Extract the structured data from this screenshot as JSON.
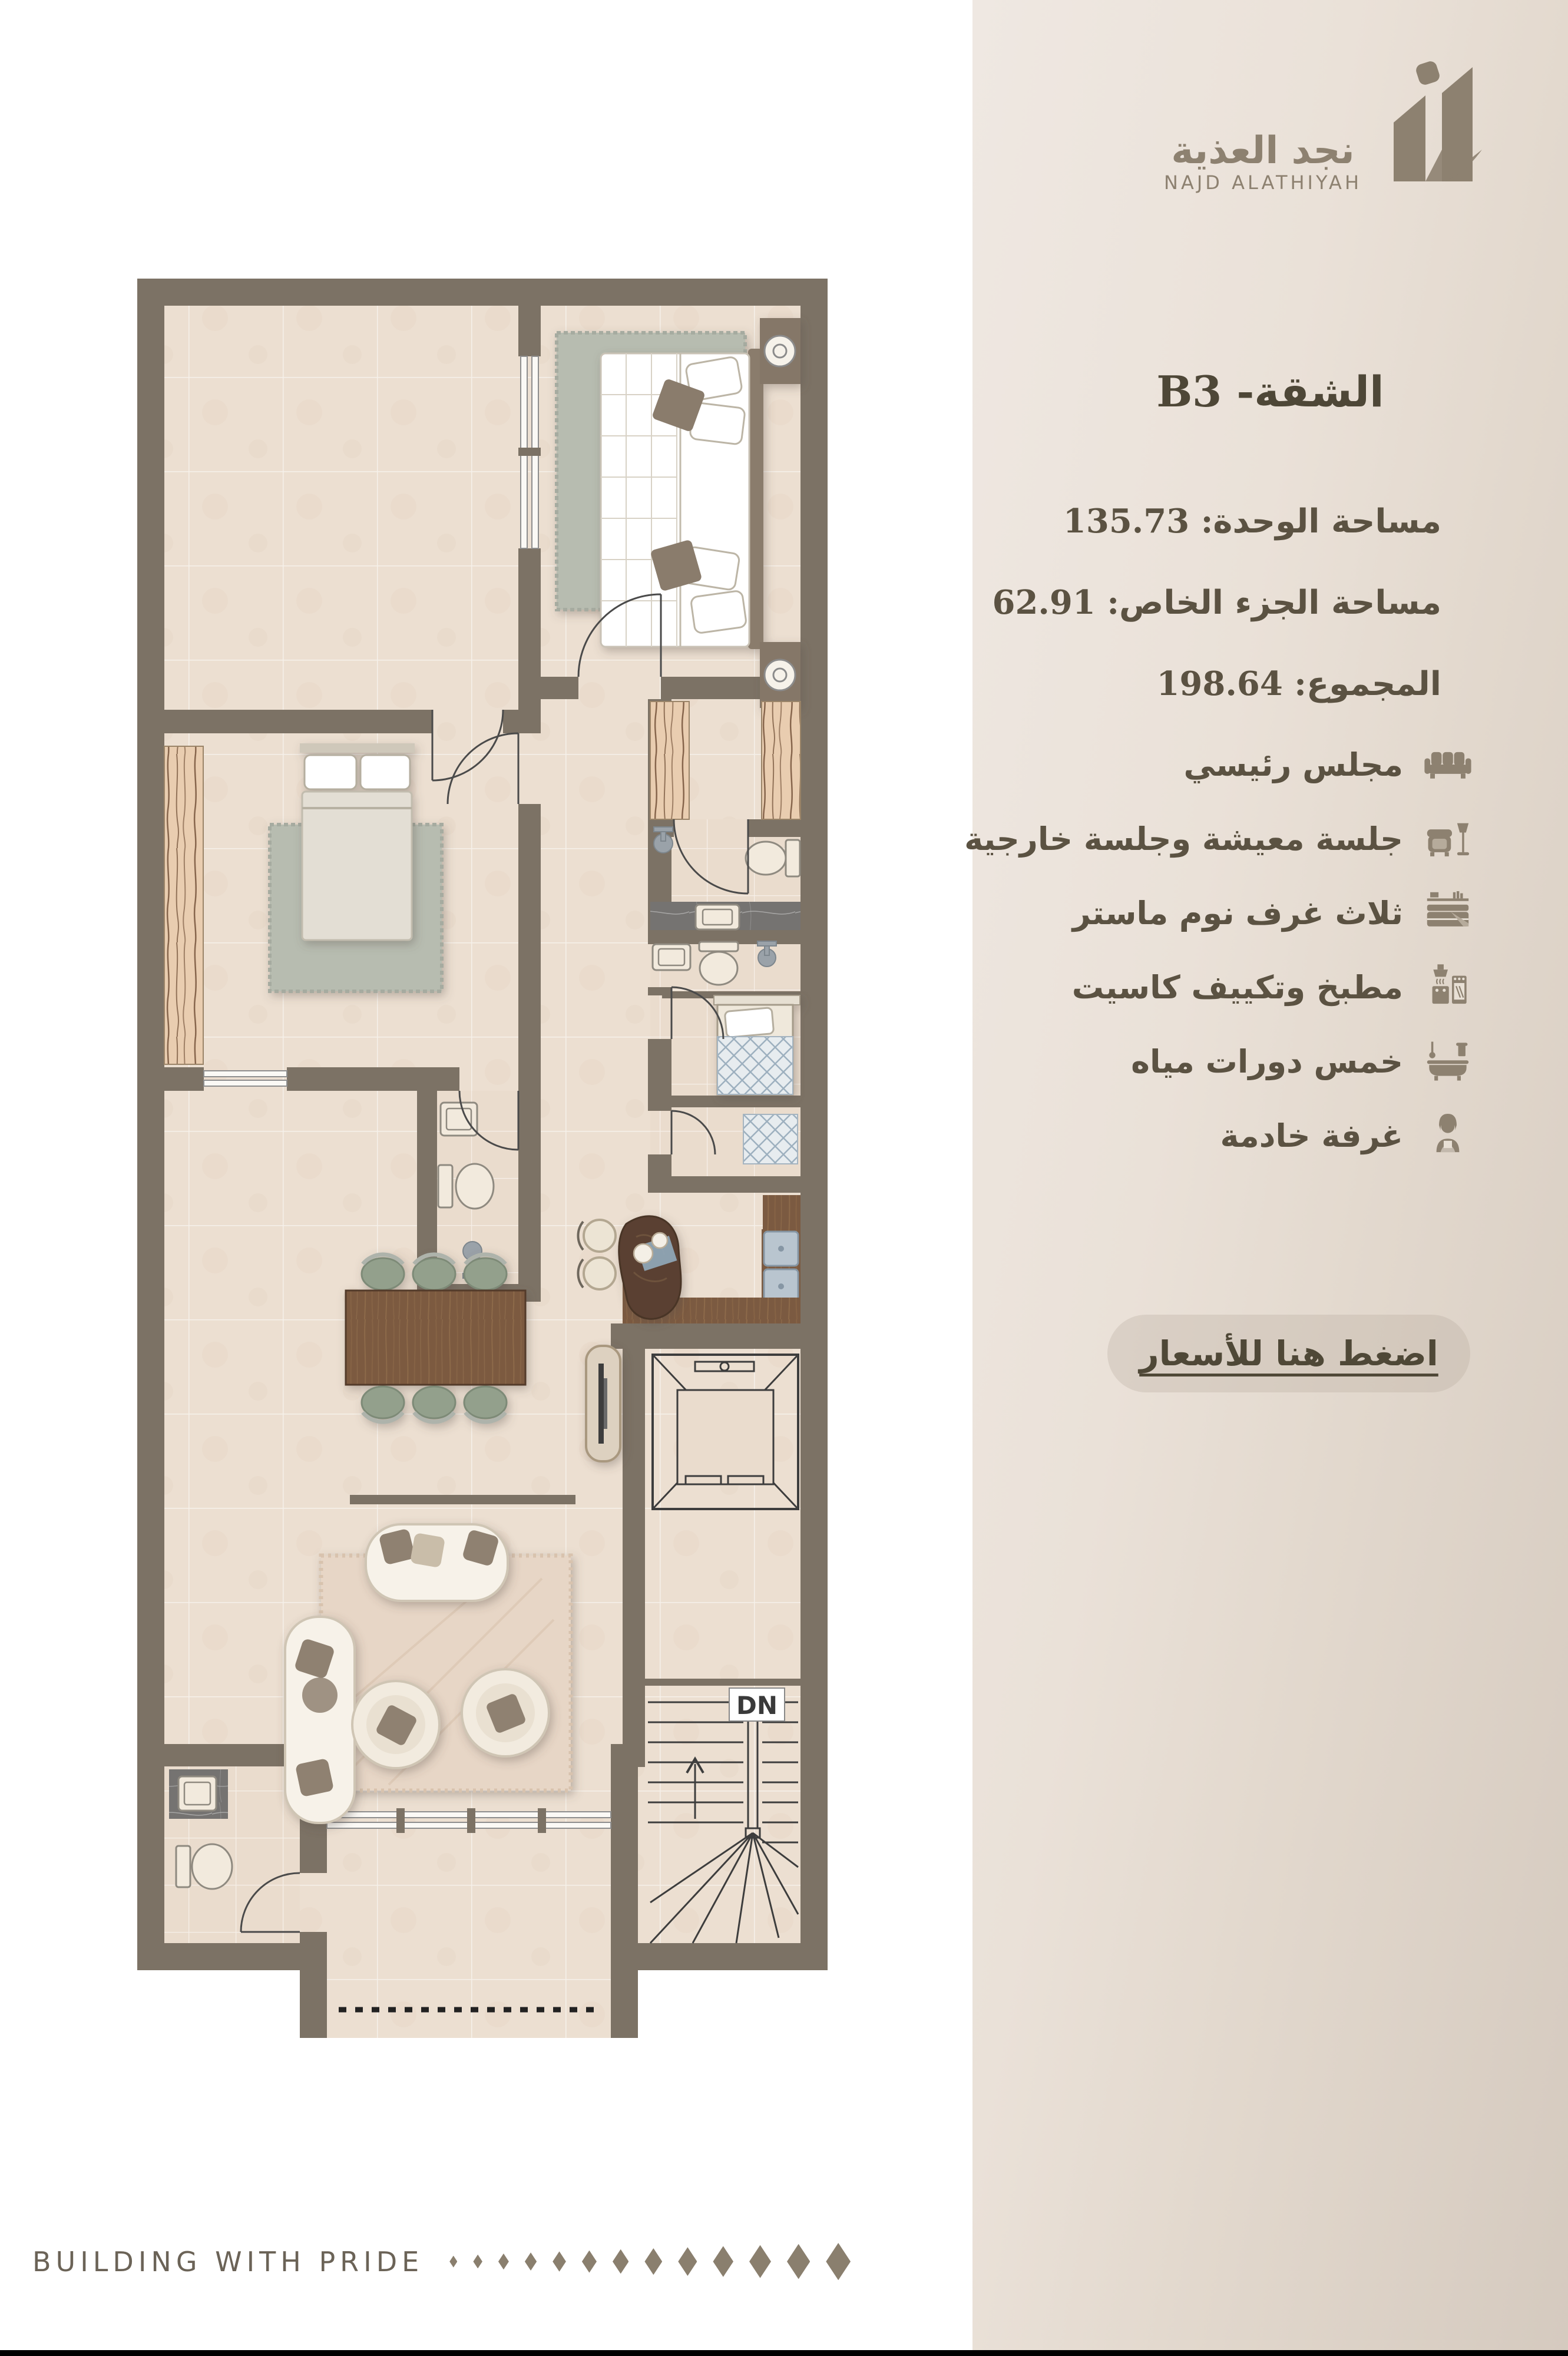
{
  "brand": {
    "logo_ar": "نجد العذية",
    "logo_en": "NAJD ALATHIYAH"
  },
  "unit": {
    "title": "الشقة- B3"
  },
  "specs": [
    {
      "text": "مساحة الوحدة: 135.73"
    },
    {
      "text": "مساحة الجزء الخاص: 62.91"
    },
    {
      "text": "المجموع: 198.64"
    }
  ],
  "features": [
    {
      "icon": "sofa-icon",
      "label": "مجلس رئيسي"
    },
    {
      "icon": "armchair-lamp-icon",
      "label": "جلسة معيشة وجلسة خارجية"
    },
    {
      "icon": "bed-icon",
      "label": "ثلاث غرف نوم ماستر"
    },
    {
      "icon": "kitchen-icon",
      "label": "مطبخ وتكييف كاسيت"
    },
    {
      "icon": "bathtub-icon",
      "label": "خمس دورات مياه"
    },
    {
      "icon": "maid-icon",
      "label": "غرفة خادمة"
    }
  ],
  "price_link": {
    "label": "اضغط هنا للأسعار"
  },
  "floor_plan": {
    "stairs_label": "DN"
  },
  "footer": {
    "tagline": "BUILDING WITH PRIDE",
    "diamond_count": 13
  },
  "colors": {
    "accent": "#8d8170",
    "text": "#5b5242",
    "wall": "#7c7265",
    "floor": "#ecdfd1",
    "panel_light": "#efe8e2",
    "panel_dark": "#d5cabf",
    "sage": "#b7bcb0",
    "wood_dark": "#7b5a41"
  }
}
